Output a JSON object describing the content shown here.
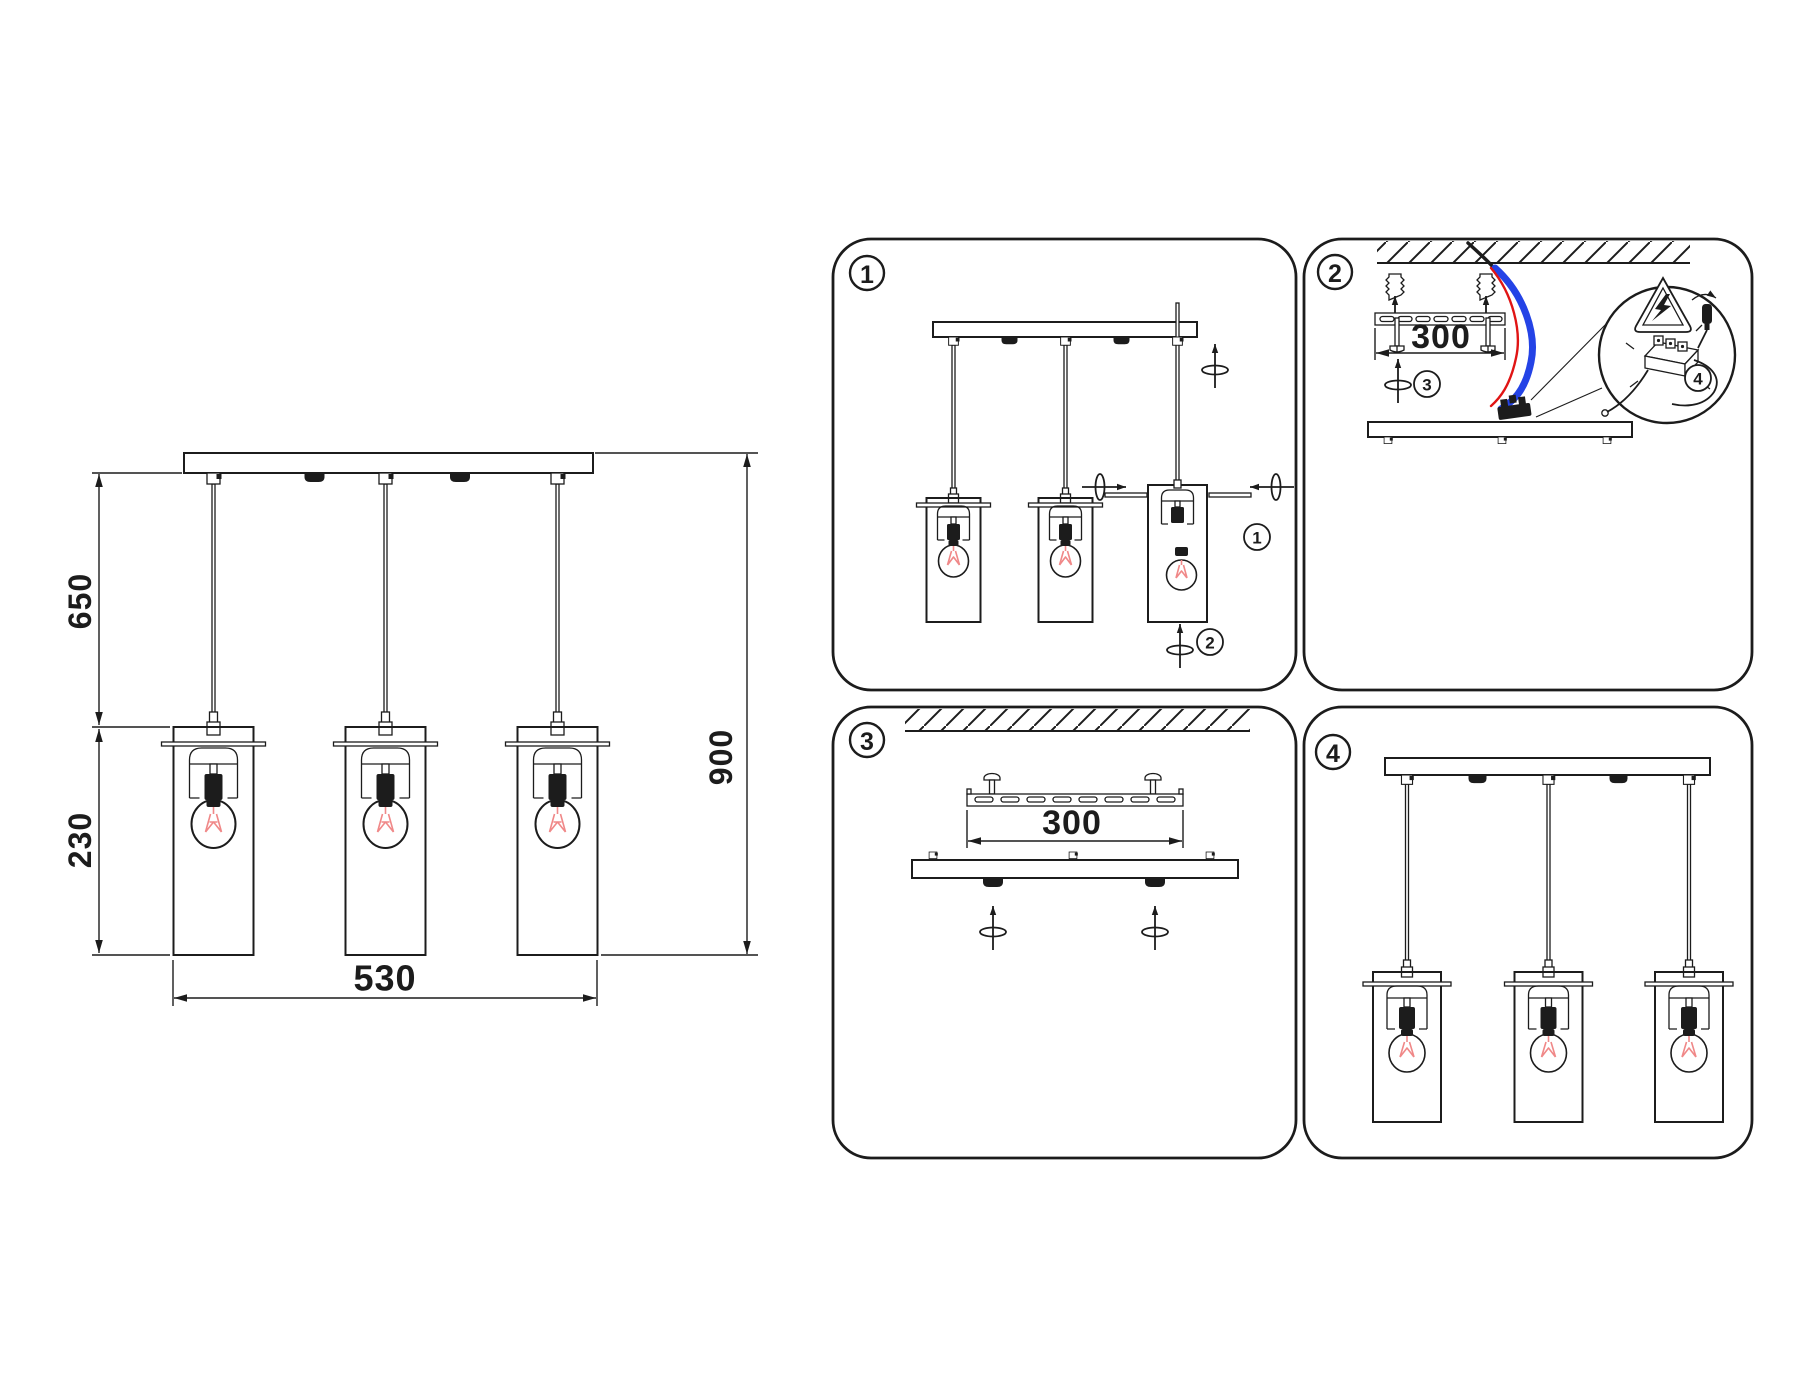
{
  "main_drawing": {
    "dim_drop": "650",
    "dim_shade": "230",
    "dim_overall": "900",
    "dim_spread": "530"
  },
  "panels": [
    {
      "badge": "1",
      "refs": {
        "ring": "1",
        "shade": "2"
      }
    },
    {
      "badge": "2",
      "bracket_dim": "300",
      "refs": {
        "canopy": "3",
        "wiring": "4"
      }
    },
    {
      "badge": "3",
      "bracket_dim": "300"
    },
    {
      "badge": "4"
    }
  ],
  "colors": {
    "ink": "#1c1c1c",
    "filament_red": "#f08888",
    "wire_blue": "#2443e6",
    "wire_red": "#e01414",
    "paper": "#ffffff"
  }
}
